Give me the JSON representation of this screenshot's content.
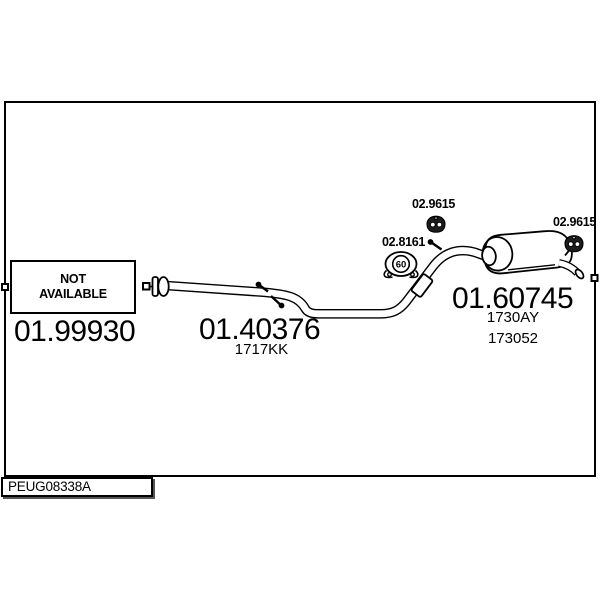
{
  "page": {
    "background": "#ffffff",
    "line_color": "#000000"
  },
  "not_available_box": {
    "line1": "NOT",
    "line2": "AVAILABLE"
  },
  "parts": {
    "front_pipe": {
      "number": "01.99930"
    },
    "center_pipe": {
      "number": "01.40376",
      "ref": "1717KK"
    },
    "rear_silencer": {
      "number": "01.60745",
      "ref1": "1730AY",
      "ref2": "173052"
    }
  },
  "mounts": {
    "hanger_mid": {
      "number": "02.9615"
    },
    "hanger_rear": {
      "number": "02.9615"
    },
    "clamp": {
      "number": "02.8161",
      "diameter": "60"
    }
  },
  "footer": {
    "code": "PEUG08338A"
  }
}
